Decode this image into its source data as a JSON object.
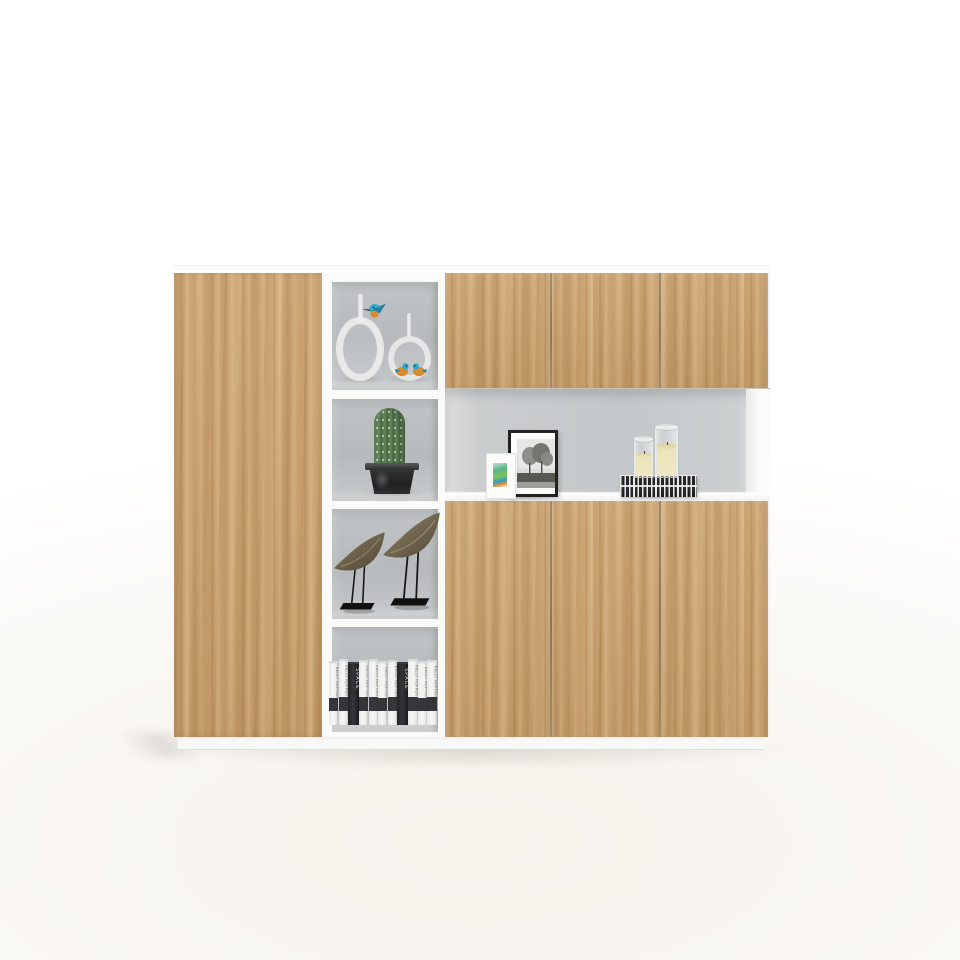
{
  "scene": {
    "type": "furniture product photo",
    "subject": "Modern office storage cabinet with oak-finish doors, white frame and open display shelves",
    "background_color": "#ffffff",
    "floor_tint": "#f6f2ec"
  },
  "cabinet": {
    "wood_color": "#c79d68",
    "wood_grain_dark": "#7a562d",
    "wood_grain_light": "#ffeac4",
    "frame_color": "#fafaf9",
    "interior_back_color": "#bcc0c2",
    "door_seam_color": "#6d5638",
    "plinth_color": "#f8f8f7",
    "left_section": {
      "doors": 1,
      "style": "full-height wood door"
    },
    "middle_section": {
      "open_cells": 4
    },
    "right_section": {
      "top_doors": 3,
      "bottom_doors": 3,
      "open_niche": 1
    }
  },
  "middle_shelf": {
    "cell_1": {
      "items": [
        "large oval hoop ornament with stem",
        "round hoop ornament with stem",
        "kingfisher figurine on stem",
        "pair of small bird figurines inside hoop"
      ],
      "hoop_color": "#ebedec",
      "bird_teal": "#2fa9c9",
      "bird_orange": "#e0892e"
    },
    "cell_2": {
      "items": [
        "columnar cactus in dark planter"
      ],
      "cactus_color": "#55784e",
      "pot_color": "#26292a"
    },
    "cell_3": {
      "items": [
        "two bronze bird sculptures on black wire stands"
      ],
      "sculpture_color": "#74694f",
      "stand_color": "#141414"
    },
    "cell_4": {
      "items": [
        "row of upright books"
      ],
      "books": [
        {
          "text": "KELLY HOPPEN",
          "color": "white"
        },
        {
          "text": "KELLY HOPPEN",
          "color": "white"
        },
        {
          "text": "SPACE",
          "color": "black"
        },
        {
          "text": "KELLY HOPPEN",
          "color": "white"
        },
        {
          "text": "KELLY HOPPEN",
          "color": "white"
        },
        {
          "text": "KELLY HOPPEN",
          "color": "white"
        },
        {
          "text": "KELLY HOPPEN",
          "color": "white"
        },
        {
          "text": "SPACE",
          "color": "black"
        },
        {
          "text": "KELLY HOPPEN",
          "color": "white"
        },
        {
          "text": "KELLY HOPPEN",
          "color": "white"
        },
        {
          "text": "KELLY HOPPEN",
          "color": "white"
        }
      ]
    }
  },
  "display_niche": {
    "items": [
      {
        "name": "small white art frame",
        "art": "green and orange abstract print"
      },
      {
        "name": "black photo frame",
        "photo": "black and white landscape with trees",
        "mat": "white"
      },
      {
        "name": "stack of two patterned books",
        "color": "#222226"
      },
      {
        "name": "two glass hurricane candle holders with ivory pillar candles",
        "wax_color": "#ece4ba"
      }
    ]
  }
}
